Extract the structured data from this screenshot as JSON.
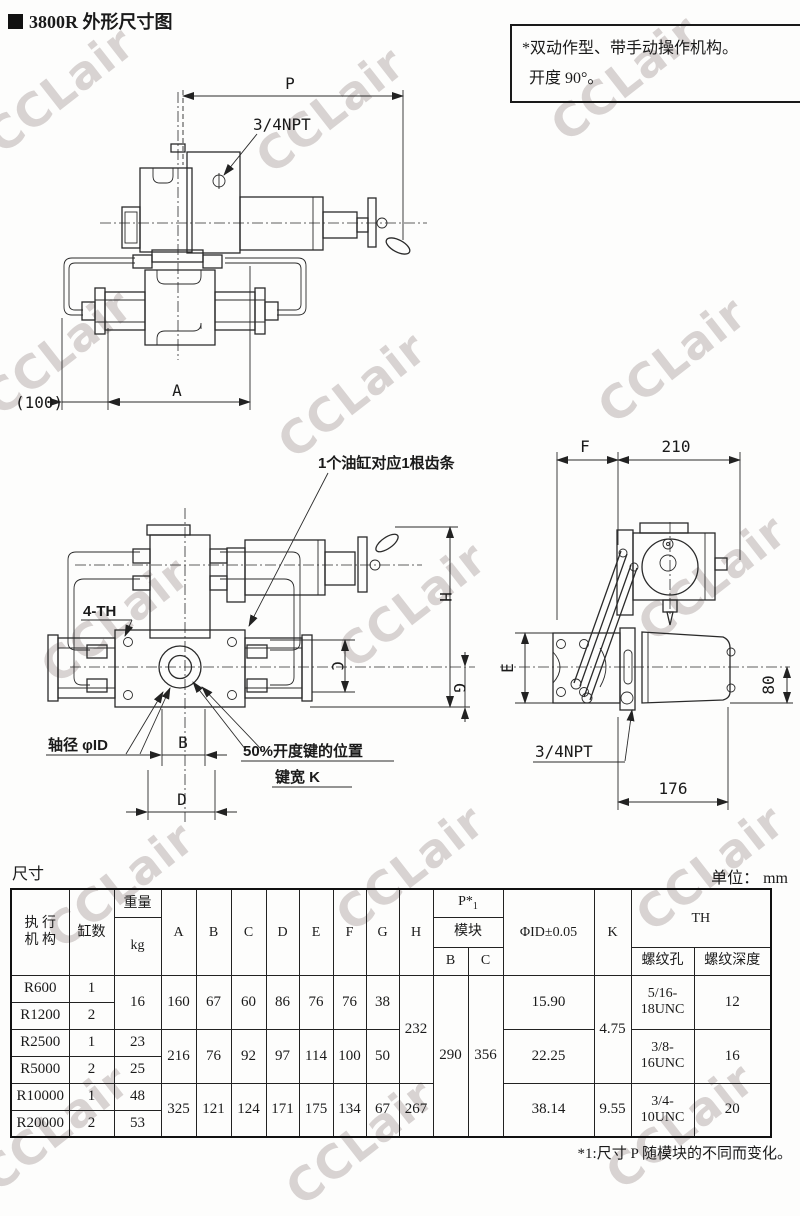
{
  "page": {
    "title": "3800R 外形尺寸图",
    "watermark": "CCLair",
    "note": {
      "line1": "*双动作型、带手动操作机构。",
      "line2": "开度 90°。"
    },
    "footnote": "*1:尺寸 P 随模块的不同而变化。"
  },
  "drawing_top": {
    "dim_P": "P",
    "port": "3/4NPT",
    "dim_100": "(100)",
    "dim_A": "A"
  },
  "drawing_front": {
    "callout_rack": "1个油缸对应1根齿条",
    "callout_th": "4-TH",
    "callout_shaft": "轴径  φID",
    "key_line1": "50%开度键的位置",
    "key_line2": "键宽  K",
    "dim_B": "B",
    "dim_D": "D",
    "dim_H": "H",
    "dim_C": "C",
    "dim_G": "G"
  },
  "drawing_side": {
    "dim_F": "F",
    "dim_210": "210",
    "dim_E": "E",
    "dim_80": "80",
    "port": "3/4NPT",
    "dim_176": "176"
  },
  "table": {
    "label": "尺寸",
    "unit": "单位： mm",
    "header": {
      "actuator_line1": "执  行",
      "actuator_line2": "机  构",
      "cylinders": "缸数",
      "weight": "重量",
      "weight_unit": "kg",
      "dims": [
        "A",
        "B",
        "C",
        "D",
        "E",
        "F",
        "G",
        "H"
      ],
      "p_label": "P*",
      "p_sub": "1",
      "module": "模块",
      "module_b": "B",
      "module_c": "C",
      "id": "ΦID±0.05",
      "k": "K",
      "th": "TH",
      "th_hole": "螺纹孔",
      "th_depth": "螺纹深度"
    },
    "rows": [
      {
        "model": "R600",
        "cyl": "1",
        "weight": "16",
        "A": "160",
        "B": "67",
        "C": "60",
        "D": "86",
        "E": "76",
        "F": "76",
        "G": "38",
        "H": "232",
        "modB": "290",
        "modC": "356",
        "id": "15.90",
        "K": "4.75",
        "hole1": "5/16-",
        "hole2": "18UNC",
        "depth": "12"
      },
      {
        "model": "R1200",
        "cyl": "2"
      },
      {
        "model": "R2500",
        "cyl": "1",
        "weight": "23",
        "A": "216",
        "B": "76",
        "C": "92",
        "D": "97",
        "E": "114",
        "F": "100",
        "G": "50",
        "id": "22.25",
        "hole1": "3/8-",
        "hole2": "16UNC",
        "depth": "16"
      },
      {
        "model": "R5000",
        "cyl": "2",
        "weight": "25"
      },
      {
        "model": "R10000",
        "cyl": "1",
        "weight": "48",
        "A": "325",
        "B": "121",
        "C": "124",
        "D": "171",
        "E": "175",
        "F": "134",
        "G": "67",
        "H": "267",
        "id": "38.14",
        "K": "9.55",
        "hole1": "3/4-",
        "hole2": "10UNC",
        "depth": "20"
      },
      {
        "model": "R20000",
        "cyl": "2",
        "weight": "53"
      }
    ]
  }
}
